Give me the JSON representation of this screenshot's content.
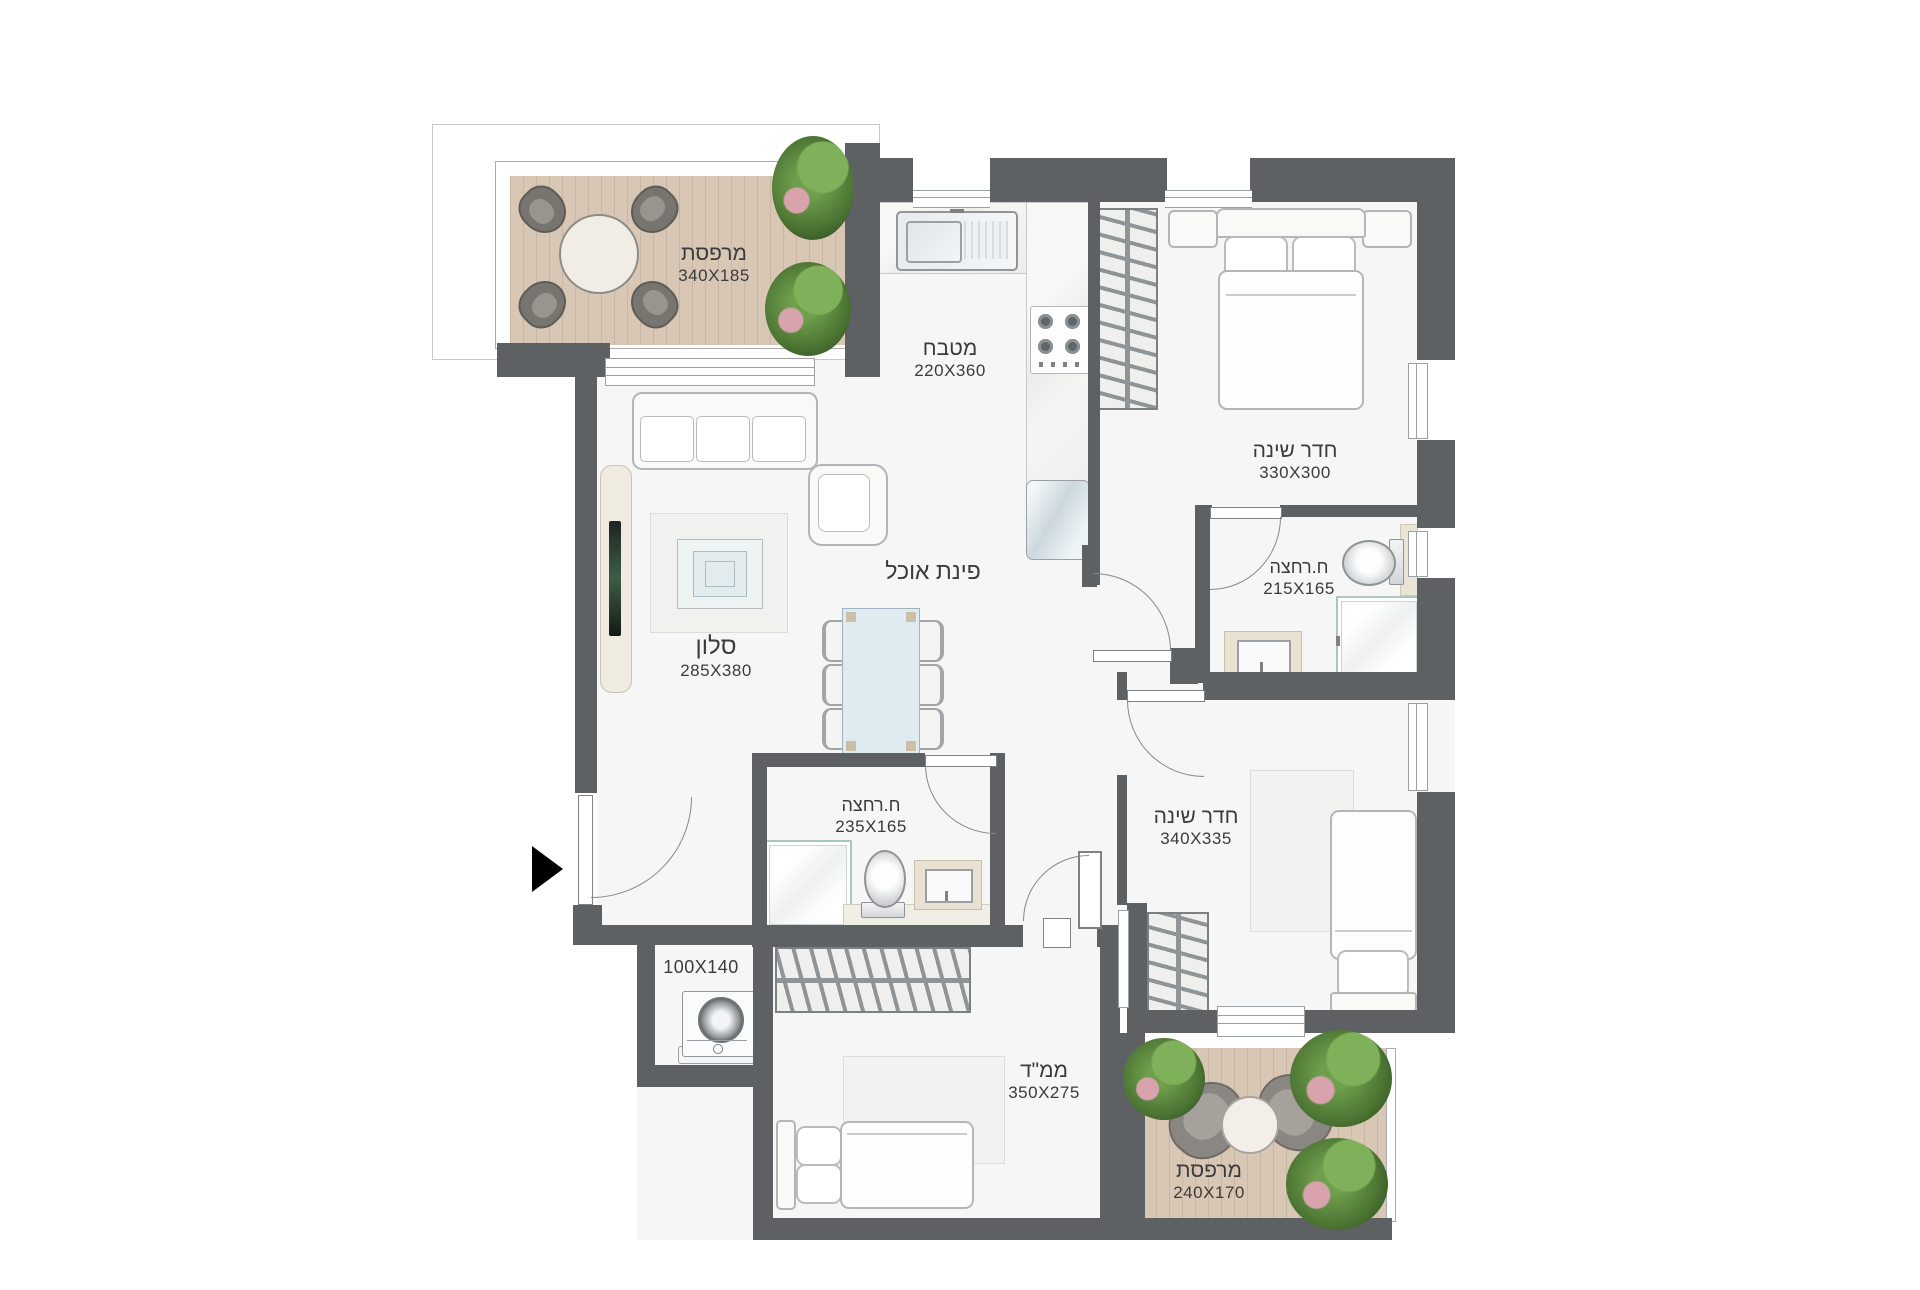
{
  "plan": {
    "type": "apartment-floor-plan",
    "language": "he",
    "rooms": [
      {
        "id": "balcony-top",
        "name": "מרפסת",
        "dims": "340X185"
      },
      {
        "id": "kitchen",
        "name": "מטבח",
        "dims": "220X360"
      },
      {
        "id": "bedroom-1",
        "name": "חדר שינה",
        "dims": "330X300"
      },
      {
        "id": "bathroom-1",
        "name": "ח.רחצה",
        "dims": "215X165"
      },
      {
        "id": "dining",
        "name": "פינת אוכל",
        "dims": ""
      },
      {
        "id": "living-room",
        "name": "סלון",
        "dims": "285X380"
      },
      {
        "id": "bathroom-2",
        "name": "ח.רחצה",
        "dims": "235X165"
      },
      {
        "id": "bedroom-2",
        "name": "חדר שינה",
        "dims": "340X335"
      },
      {
        "id": "utility",
        "name": "",
        "dims": "100X140"
      },
      {
        "id": "mamad",
        "name": "ממ\"ד",
        "dims": "350X275"
      },
      {
        "id": "balcony-bottom",
        "name": "מרפסת",
        "dims": "240X170"
      }
    ],
    "colors": {
      "wall": "#5d6164",
      "floor": "#f6f6f7",
      "deck": "#d8c7b4",
      "counter_beige": "#e9e2d2",
      "label_text": "#3b3b3d"
    }
  }
}
